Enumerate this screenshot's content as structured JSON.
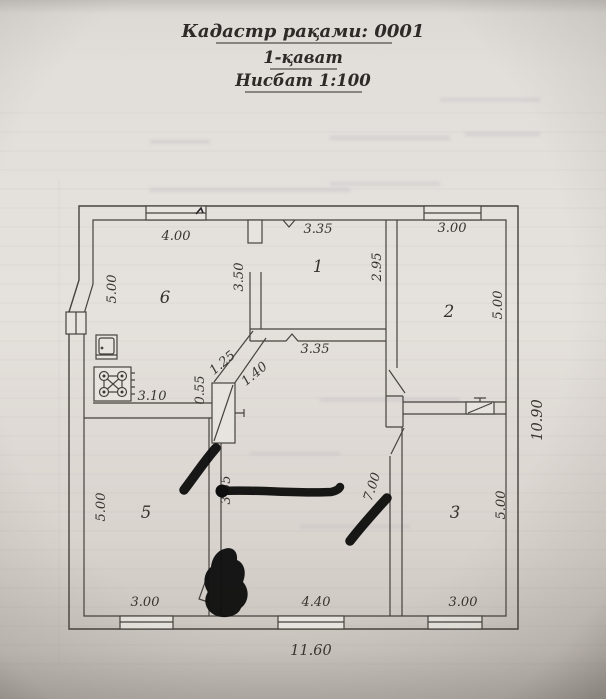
{
  "header": {
    "cadastre_line": "Кадастр рақами: 0001",
    "floor_line": "1-қават",
    "scale_line": "Нисбат 1:100"
  },
  "floor_plan": {
    "room_numbers": [
      {
        "label": "6"
      },
      {
        "label": "1"
      },
      {
        "label": "2"
      },
      {
        "label": "3"
      },
      {
        "label": "5"
      }
    ],
    "dimension_labels": [
      {
        "text": "4.00"
      },
      {
        "text": "3.35"
      },
      {
        "text": "3.00"
      },
      {
        "text": "5.00"
      },
      {
        "text": "3.50"
      },
      {
        "text": "2.95"
      },
      {
        "text": "5.00"
      },
      {
        "text": "3.35"
      },
      {
        "text": "1.25"
      },
      {
        "text": "1.40"
      },
      {
        "text": "0.55"
      },
      {
        "text": "3.10"
      },
      {
        "text": "3.55"
      },
      {
        "text": "7.00"
      },
      {
        "text": "5.00"
      },
      {
        "text": "5.00"
      },
      {
        "text": "10.90"
      },
      {
        "text": "3.00"
      },
      {
        "text": "4.40"
      },
      {
        "text": "3.00"
      },
      {
        "text": "11.60"
      }
    ],
    "colors": {
      "paper": "#e6e2de",
      "ink": "#46423d",
      "marker": "#0f0f0f",
      "label_ink": "#38342f"
    }
  }
}
